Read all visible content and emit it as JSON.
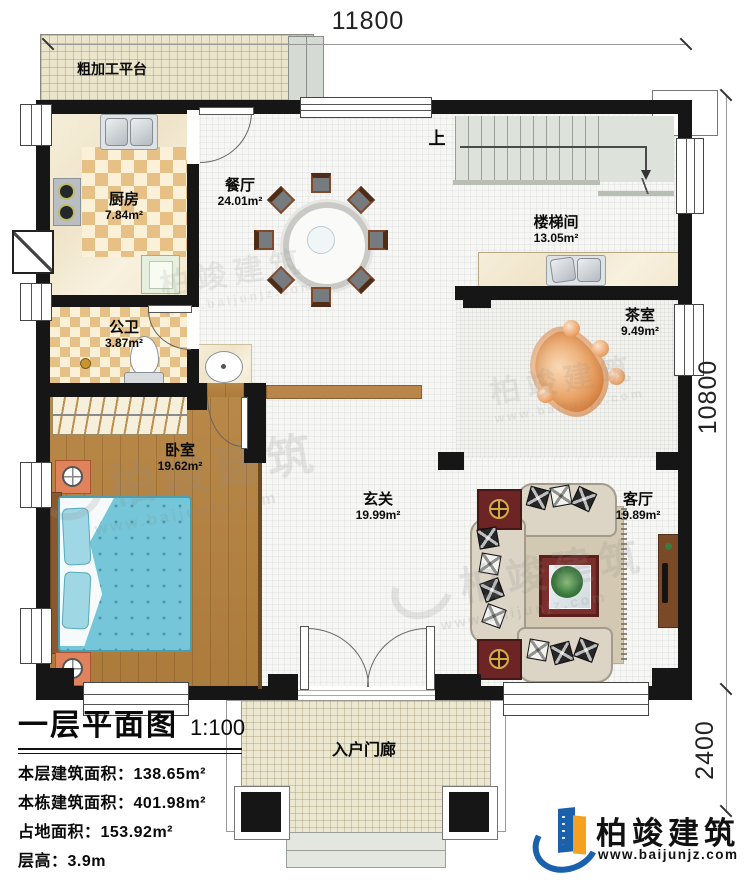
{
  "dimensions": {
    "top": "11800",
    "right_upper": "10800",
    "right_lower": "2400"
  },
  "stairs": {
    "up": "上"
  },
  "rooms": {
    "platform": {
      "name": "粗加工平台"
    },
    "kitchen": {
      "name": "厨房",
      "area": "7.84m²"
    },
    "dining": {
      "name": "餐厅",
      "area": "24.01m²"
    },
    "stairwell": {
      "name": "楼梯间",
      "area": "13.05m²"
    },
    "tea": {
      "name": "茶室",
      "area": "9.49m²"
    },
    "bath": {
      "name": "公卫",
      "area": "3.87m²"
    },
    "bedroom": {
      "name": "卧室",
      "area": "19.62m²"
    },
    "foyer": {
      "name": "玄关",
      "area": "19.99m²"
    },
    "living": {
      "name": "客厅",
      "area": "19.89m²"
    },
    "porch": {
      "name": "入户门廊"
    }
  },
  "title_block": {
    "title": "一层平面图",
    "scale": "1:100",
    "lines": [
      "本层建筑面积：138.65m²",
      "本栋建筑面积：401.98m²",
      "占地面积：153.92m²",
      "层高：3.9m",
      "注：阳台算半面积，露台不算面积"
    ]
  },
  "brand": {
    "name": "柏竣建筑",
    "url": "www.baijunjz.com"
  },
  "watermark": {
    "name": "柏竣建筑",
    "url": "www.baijunjz.com"
  },
  "colors": {
    "wall": "#161616",
    "wood": "#b5823f",
    "bed": "#74c6d8",
    "tea_table": "#e0914f",
    "logo_blue": "#1961ac",
    "logo_orange": "#f5a01e"
  }
}
